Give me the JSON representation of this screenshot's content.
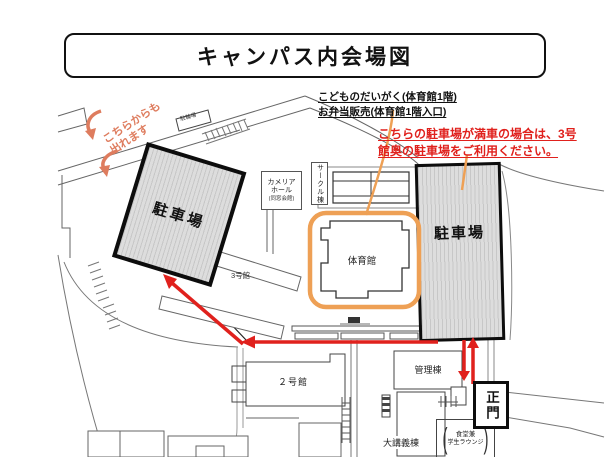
{
  "title": "キャンパス内会場図",
  "annotations": {
    "kids_univ_line1": "こどものだいがく(体育館1階)",
    "kids_univ_line2": "お弁当販売(体育館1階入口)",
    "full_lot_line1": "こちらの駐車場が満車の場合は、3号",
    "full_lot_line2": "館奥の駐車場をご利用ください。",
    "exit_line1": "こちらからも",
    "exit_line2": "出れます"
  },
  "labels": {
    "parking_left": "駐車場",
    "parking_right": "駐車場",
    "gym": "体育館",
    "camellia_line1": "カメリア",
    "camellia_line2": "ホール",
    "camellia_line3": "(同窓会館)",
    "circle_building": "サークル棟",
    "building3": "3号館",
    "building2": "２号館",
    "admin_building": "管理棟",
    "lecture_building": "大講義棟",
    "main_gate": "正門",
    "cafeteria_line1": "食堂兼",
    "cafeteria_line2": "学生ラウンジ",
    "cafeteria_paren_left": "(",
    "cafeteria_paren_right": ")",
    "bicycle_parking": "駐輪場"
  },
  "colors": {
    "route_red": "#e0211d",
    "highlight_orange": "#eea055",
    "exit_salmon": "#de7c5e",
    "parking_fill": "#dddddd",
    "parking_stripe": "#c7c7c7",
    "outline_gray": "#666666",
    "border_black": "#0d0d0d"
  }
}
